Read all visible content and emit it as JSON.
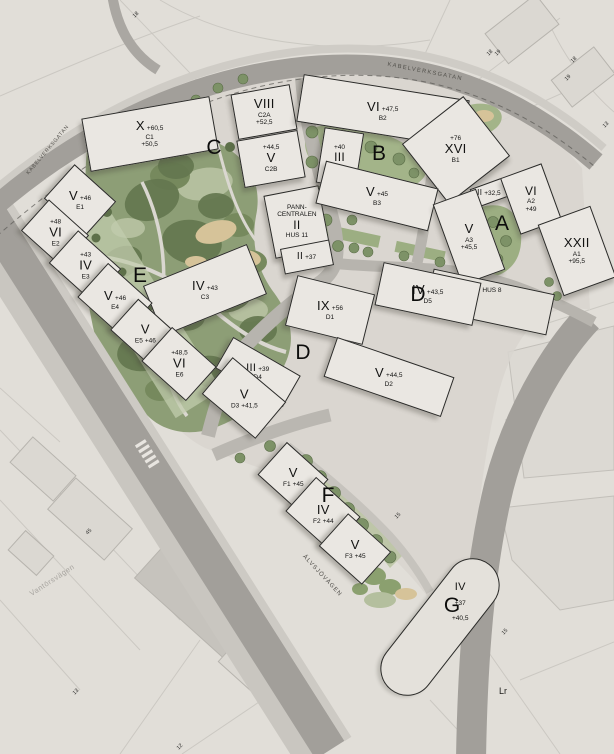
{
  "map": {
    "street_labels": [
      "KABELVERKSGATAN",
      "ÄLVSJÖVÄGEN",
      "KABELVERKSGATAN",
      "Vantörsvägen",
      "Lr"
    ],
    "quarters": [
      "C",
      "B",
      "A",
      "D",
      "E",
      "D",
      "F",
      "G"
    ],
    "buildings": [
      {
        "id": "c1",
        "roman": "X",
        "height": "+60,5",
        "code": "C1",
        "note": "+50,5"
      },
      {
        "id": "c2a",
        "roman": "VIII",
        "code": "C2A",
        "height": "+52,5"
      },
      {
        "id": "c2b",
        "roman": "V",
        "code": "C2B",
        "height": "+44,5"
      },
      {
        "id": "c3",
        "roman": "IV",
        "height": "+43",
        "code": "C3"
      },
      {
        "id": "pann",
        "note": "PANN-CENTRALEN",
        "roman": "II",
        "code": "HUS 11"
      },
      {
        "id": "pann-annex",
        "roman": "II",
        "height": "+37"
      },
      {
        "id": "b2",
        "roman": "VI",
        "height": "+47,5",
        "code": "B2"
      },
      {
        "id": "b4",
        "roman": "III",
        "height": "+40",
        "code": "B4"
      },
      {
        "id": "b1",
        "roman": "XVI",
        "height": "+76",
        "code": "B1"
      },
      {
        "id": "b3",
        "roman": "V",
        "height": "+45",
        "code": "B3"
      },
      {
        "id": "a4",
        "roman": "II",
        "height": "+32,5"
      },
      {
        "id": "a2",
        "roman": "VI",
        "code": "A2",
        "height": "+49"
      },
      {
        "id": "a3",
        "roman": "V",
        "code": "A3",
        "height": "+45,5"
      },
      {
        "id": "a1",
        "roman": "XXII",
        "code": "A1",
        "height": "+95,5"
      },
      {
        "id": "hus8",
        "code": "HUS 8"
      },
      {
        "id": "d5",
        "roman": "IV",
        "height": "+43,5",
        "code": "D5"
      },
      {
        "id": "d1",
        "roman": "IX",
        "height": "+56",
        "code": "D1"
      },
      {
        "id": "d4",
        "roman": "III",
        "height": "+39",
        "code": "D4"
      },
      {
        "id": "d2",
        "roman": "V",
        "height": "+44,5",
        "code": "D2"
      },
      {
        "id": "d3",
        "roman": "V",
        "code": "D3",
        "height": "+41,5"
      },
      {
        "id": "e1",
        "roman": "V",
        "height": "+46",
        "code": "E1"
      },
      {
        "id": "e2",
        "roman": "VI",
        "height": "+48",
        "code": "E2"
      },
      {
        "id": "e3",
        "roman": "IV",
        "height": "+43",
        "code": "E3"
      },
      {
        "id": "e4",
        "roman": "V",
        "height": "+46",
        "code": "E4"
      },
      {
        "id": "e5",
        "roman": "V",
        "code": "E5",
        "height": "+46"
      },
      {
        "id": "e6",
        "roman": "VI",
        "height": "+48,5",
        "code": "E6"
      },
      {
        "id": "f1",
        "roman": "V",
        "code": "F1",
        "height": "+45"
      },
      {
        "id": "f2",
        "roman": "IV",
        "code": "F2",
        "height": "+44"
      },
      {
        "id": "f3",
        "roman": "V",
        "code": "F3",
        "height": "+45"
      },
      {
        "id": "g",
        "roman": "IV",
        "height": "+37",
        "note": "+40,5"
      }
    ],
    "small_numbers": [
      "18",
      "18",
      "19",
      "18",
      "19",
      "13",
      "15",
      "15",
      "45",
      "13",
      "12"
    ],
    "colors": {
      "background": "#e1ded8",
      "road": "#a29f9a",
      "minor_road": "#b7b4ae",
      "paving": "#d8d5cf",
      "park": "#8d9e76",
      "tree_dark": "#64774f",
      "lawn": "#b4bf9e",
      "sand": "#d6c399",
      "building_fill": "#eae7e2",
      "building_outline": "#2a2a28"
    }
  }
}
